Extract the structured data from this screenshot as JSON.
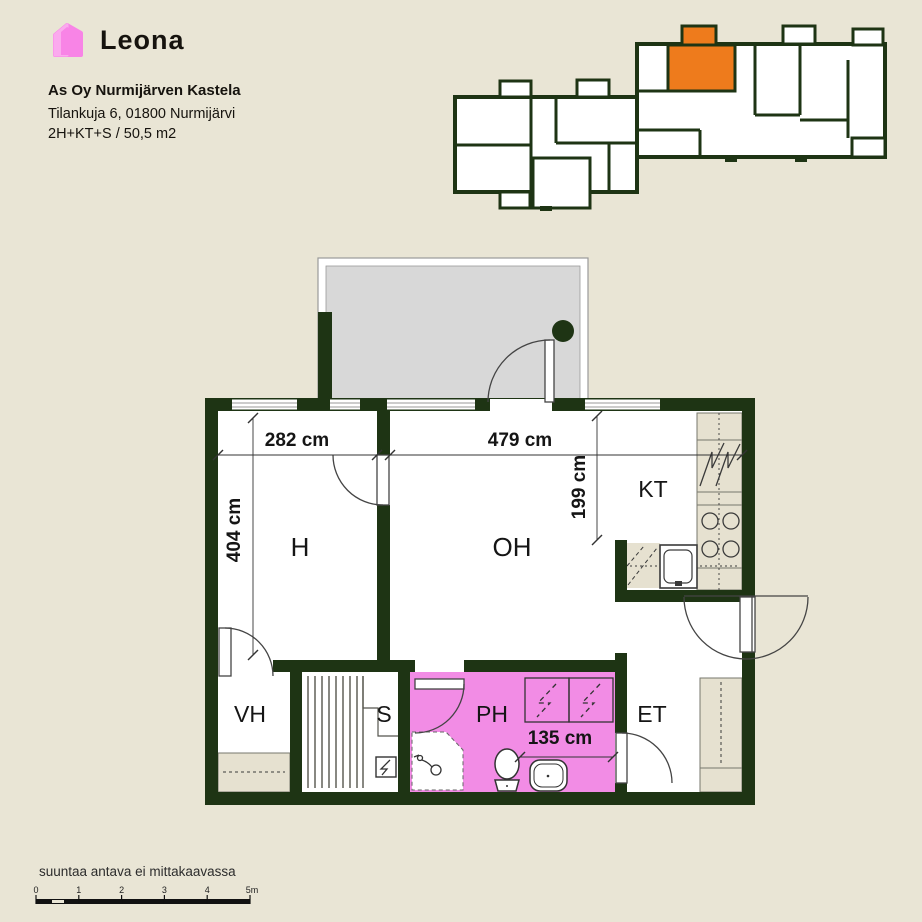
{
  "logo": {
    "brand": "Leona"
  },
  "header": {
    "company": "As Oy Nurmijärven Kastela",
    "address": "Tilankuja 6, 01800 Nurmijärvi",
    "apartment_type": "2H+KT+S / 50,5 m2"
  },
  "floor_plan": {
    "rooms": {
      "h": "H",
      "oh": "OH",
      "kt": "KT",
      "vh": "VH",
      "s": "S",
      "ph": "PH",
      "et": "ET"
    },
    "dimensions": {
      "h_width": "282 cm",
      "oh_width": "479 cm",
      "h_depth": "404 cm",
      "kt_depth": "199 cm",
      "ph_width": "135 cm"
    }
  },
  "footer": {
    "disclaimer": "suuntaa antava ei mittakaavassa",
    "scale_labels": [
      "0",
      "1",
      "2",
      "3",
      "4",
      "5m"
    ]
  },
  "colors": {
    "background": "#e9e5d5",
    "wall": "#1e3414",
    "balcony_floor": "#d8d8d8",
    "bathroom_pink": "#f28ce5",
    "highlight_orange": "#ee7b1c",
    "counter_beige": "#e6e1d0",
    "logo_pink": "#f884e6",
    "logo_pink_light": "#fcb1f0"
  }
}
